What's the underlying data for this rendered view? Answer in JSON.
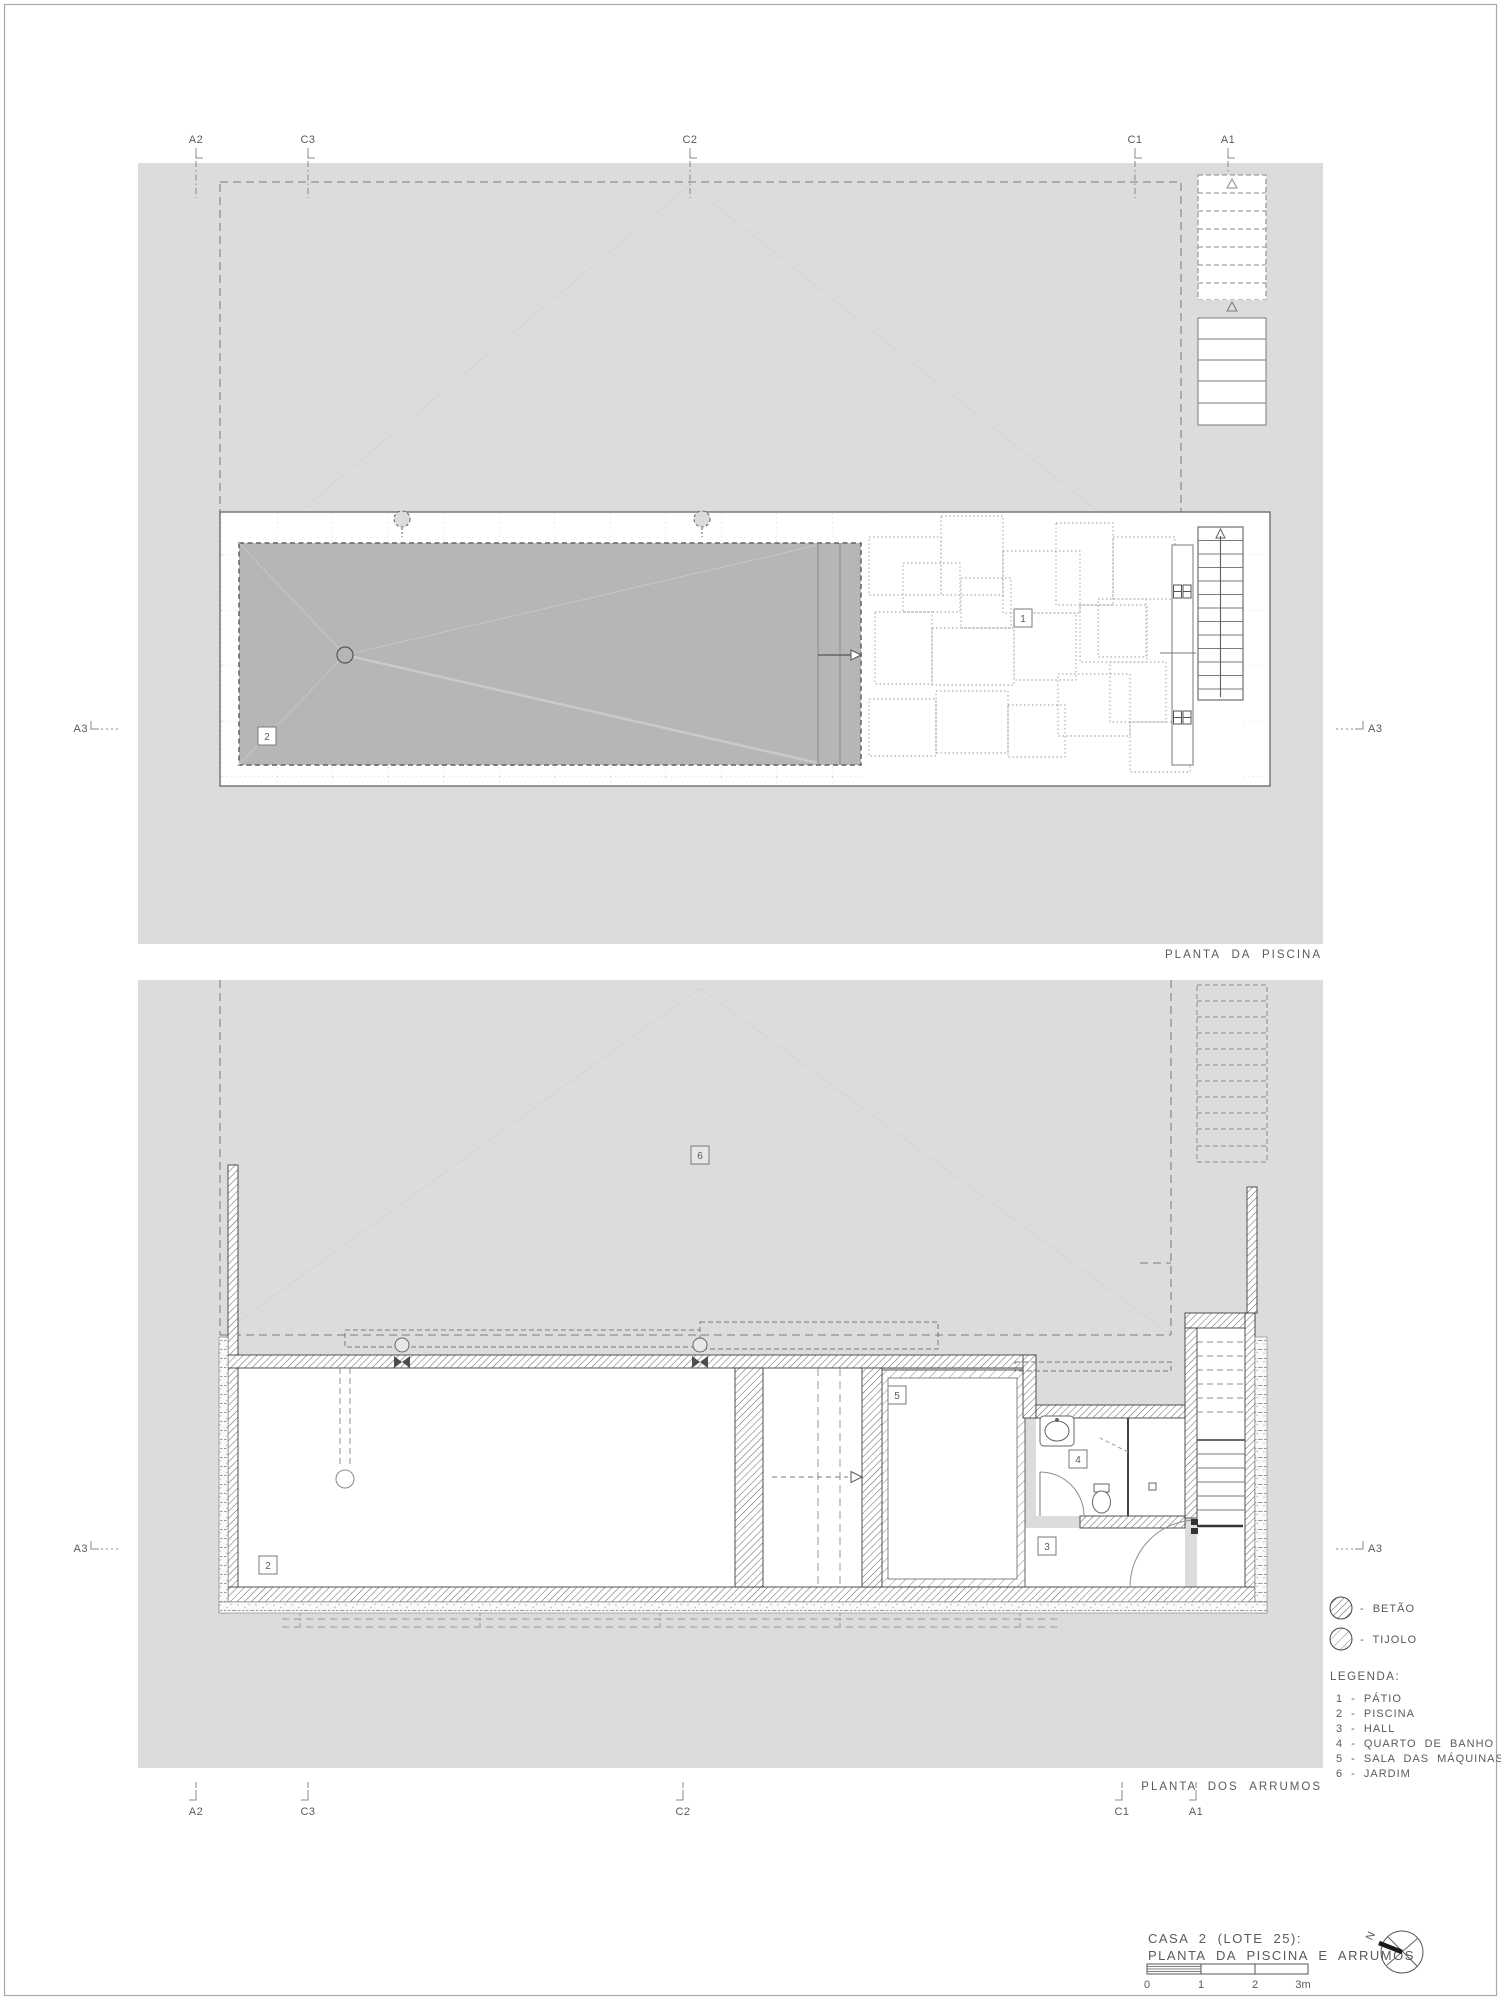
{
  "plans": {
    "upper_title": "PLANTA DA PISCINA",
    "lower_title": "PLANTA DOS ARRUMOS"
  },
  "markers": {
    "top": [
      "A2",
      "C3",
      "C2",
      "C1",
      "A1"
    ],
    "bottom": [
      "A2",
      "C3",
      "C2",
      "C1",
      "A1"
    ],
    "section_side": "A3"
  },
  "room_labels": {
    "patio": "1",
    "piscina": "2",
    "hall": "3",
    "banho": "4",
    "maquinas": "5",
    "jardim": "6"
  },
  "legend": {
    "heading": "LEGENDA:",
    "materials": [
      {
        "symbol": "betao-hatch",
        "label": "- BETÃO"
      },
      {
        "symbol": "tijolo-hatch",
        "label": "- TIJOLO"
      }
    ],
    "items": [
      "1 - PÁTIO",
      "2 - PISCINA",
      "3 - HALL",
      "4 - QUARTO DE BANHO",
      "5 - SALA DAS MÁQUINAS",
      "6 - JARDIM"
    ]
  },
  "title_block": {
    "line1": "CASA 2 (LOTE 25):",
    "line2": "PLANTA DA PISCINA E ARRUMOS",
    "scale_ticks": [
      "0",
      "1",
      "2",
      "3m"
    ],
    "north_label": "N"
  },
  "colors": {
    "site_gray": "#dcdcdc",
    "pool_gray": "#b6b6b6",
    "line": "#5a5a5a"
  }
}
